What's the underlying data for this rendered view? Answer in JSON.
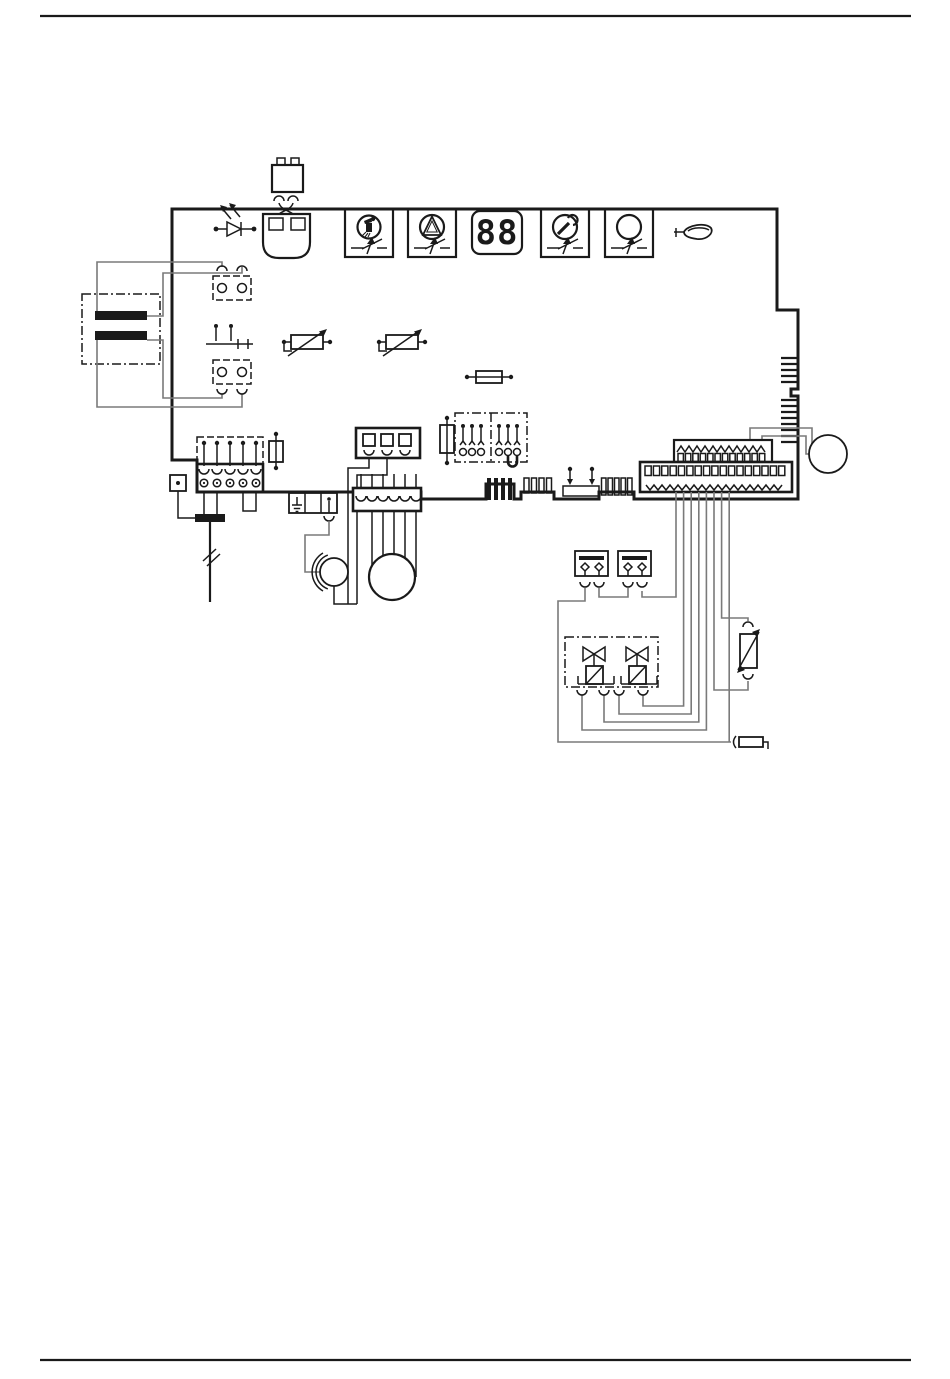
{
  "page": {
    "background": "#ffffff",
    "rule_color": "#1a1a1a"
  },
  "diagram": {
    "type": "boiler-control-board-wiring-diagram",
    "colors": {
      "line": "#1a1a1a",
      "wire": "#7a7a7a",
      "winding": "#111111"
    },
    "display": {
      "value": "88"
    },
    "panel": {
      "buttons": [
        {
          "icon": "chimney-sweep-icon"
        },
        {
          "icon": "reset-triangle-icon"
        },
        {
          "icon": "service-wrench-icon"
        },
        {
          "icon": "standby-circle-icon"
        }
      ],
      "indicator": "seven-segment-display",
      "flame_symbol": "burner-flame-icon",
      "receiver": "led-diode-icon"
    },
    "components": {
      "transformer": "mains-transformer",
      "primary_connector": "transformer-primary-connector",
      "secondary_connector": "transformer-secondary-connector",
      "selector_switch": "double-contact-switch",
      "remote_plug": "remote-control-plug",
      "remote_socket": "remote-control-socket",
      "mains_terminal": "mains-terminal-block-5pin",
      "mains_cable": "mains-supply-cable",
      "earth_tab": "earth-tab",
      "fuses": [
        "fuse-vertical-left",
        "fuse-horizontal-middle",
        "fuse-vertical-middle"
      ],
      "trimmers": [
        "potentiometer-1",
        "potentiometer-2"
      ],
      "jumper_block": "configuration-jumper-block",
      "earth_terminal_block": "earth-terminal-block",
      "igniter": "igniter-motor",
      "pump": "pump-motor",
      "pump_connector": "pump-connector-6pin",
      "aux_connector": "aux-connector-3pin",
      "upper_edge_connector": "upper-multipin-connector",
      "lower_edge_connector": "lower-multipin-connector",
      "fan": "fan-motor",
      "thermostats": [
        "limit-thermostat-1",
        "limit-thermostat-2"
      ],
      "gas_valves": [
        "gas-valve-solenoid-1",
        "gas-valve-solenoid-2"
      ],
      "modulating_coil": "modulating-coil",
      "sensor": "temperature-sensor"
    }
  }
}
